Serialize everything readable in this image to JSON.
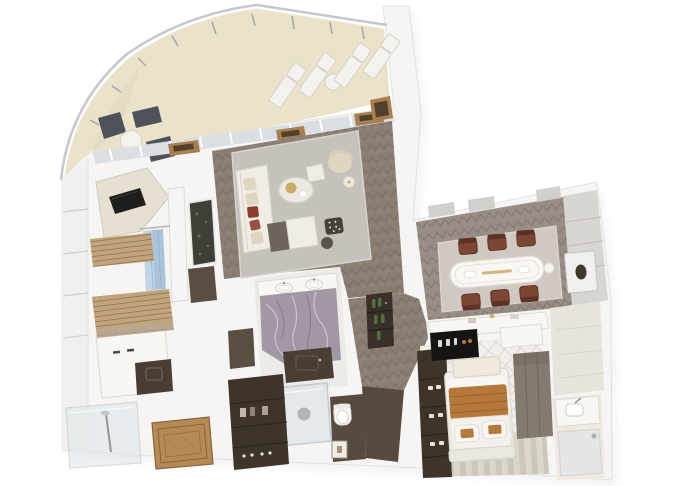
{
  "canvas": {
    "width": 680,
    "height": 486,
    "background": "#ffffff"
  },
  "image": {
    "type": "3d-floorplan-cutaway-render",
    "subject": "luxury suite top-down 3D floor plan with curved balcony",
    "text_visible": false
  },
  "palette": {
    "bg": "#ffffff",
    "wall": "#f6f5f3",
    "wall_line": "#d4d2ce",
    "hull": "#f1f0ee",
    "hull_line": "#c9ccd1",
    "railing": "#c3c8d0",
    "stanchion": "#9aa0a8",
    "awning": "#eae3ca",
    "awning_dark": "#d9d0b2",
    "glass": "#d9dfe3",
    "mullion": "#ffffff",
    "planter_wood": "#a97f4f",
    "planter_dark": "#50402c",
    "lounger": "#f4f2ed",
    "lounger_edge": "#d5d2c9",
    "bistro_dark": "#4e535a",
    "wood_floor": "#8b7f74",
    "wood_line": "#6f6459",
    "wood_hi": "#9c9186",
    "dining_floor": "#988e87",
    "rug": "#c6c2bb",
    "dining_rug": "#cfc9c1",
    "sofa": "#f1ede6",
    "sofa_edge": "#d9d4cb",
    "chaise_dark": "#6b655e",
    "pillow_cream": "#e0d5bf",
    "pillow_red": "#8e3a2d",
    "marble_top": "#ece9e3",
    "gold": "#c8a45c",
    "chair_leather": "#7c4634",
    "chair_leather_dark": "#5d3224",
    "panel_wall": "#d8d6d2",
    "panel_line": "#bfbcb8",
    "niche": "#f2f0ee",
    "niche_oval": "#41362b",
    "porcelain": "#f8f7f4",
    "bath_floor": "#edebe7",
    "marble_purple": "#a298a4",
    "marble_vein": "#d8cfd8",
    "marble_vein_dark": "#6d5f6e",
    "counter_dark": "#4a3d33",
    "cabinet_brown": "#5a4e42",
    "shower_glass": "#dfe6ea",
    "glass_frame": "#b9c2c8",
    "wc_floor": "#574b3f",
    "parquet": "#b58a55",
    "parquet_line": "#8a6336",
    "wardrobe": "#3e342a",
    "wardrobe_line": "#2a221b",
    "wardrobe_grey": "#847b70",
    "slat": "#c2a47c",
    "slat_line": "#8f7450",
    "towel": "#a9c3da",
    "towel_hi": "#c6d9e8",
    "towel_line": "#8fb0cc",
    "moss": "#3c4036",
    "moss_fleck": "#6a7060",
    "bottle": "#51713f",
    "bar_dark": "#3a3029",
    "tv": "#1f1e1c",
    "console_cream": "#e6e0d2",
    "minibar": "#161412",
    "carpet_a": "#dcd7cd",
    "carpet_b": "#cdc7bb",
    "tile": "#f1efe9",
    "tile_line": "#d9d5cb",
    "bed_white": "#f3f1ec",
    "caramel": "#b5793b",
    "caramel_line": "#96622c",
    "panel_grey": "#cfccc8",
    "entry_floor": "#e8e4dd",
    "beige_floor": "#efe9e0",
    "shadow": "#9c9a96"
  },
  "balcony": {
    "label": "curved-balcony",
    "loungers": 4,
    "lounger_side_table": 1,
    "bistro_chairs": 2,
    "bistro_tables": 2,
    "planter_boxes": 4,
    "awning_color_name": "cream"
  },
  "living_room": {
    "label": "living-room",
    "sofa_pillows": 5,
    "red_pillows": 2,
    "coffee_table": 1,
    "armchairs": 2,
    "patterned_pouf": 1,
    "moss_art_panel": 1
  },
  "dining_room": {
    "label": "dining-room",
    "chairs": 6,
    "table_shape": "oval-white",
    "wall_niche_sculpture": 1,
    "credenza": 1
  },
  "master_bedroom": {
    "label": "master-bedroom",
    "tv": 1,
    "blue_towels": 1,
    "slat_benches": 2
  },
  "master_bathroom": {
    "label": "master-bathroom",
    "sinks": 2,
    "marble_color_name": "purple-grey",
    "shower": 1,
    "wc_toilet": 1,
    "dark_vanity": 1
  },
  "walk_in_closet": {
    "label": "walk-in-closet",
    "parquet_inlay": 1,
    "dark_wardrobe": 1,
    "vanity": 1
  },
  "hallway": {
    "label": "hallway",
    "minibar_bottles": 5
  },
  "guest_bedroom": {
    "label": "guest-bedroom",
    "bed_pillows": 2,
    "caramel_runner": 1,
    "wardrobes": 2,
    "black_minibar_console": 1,
    "striped_carpet": 1
  },
  "guest_bathroom": {
    "label": "guest-bathroom",
    "sink": 1,
    "shower": 1
  },
  "extras": {
    "left_glass_shower": 1,
    "hull_window_bands": 4
  }
}
